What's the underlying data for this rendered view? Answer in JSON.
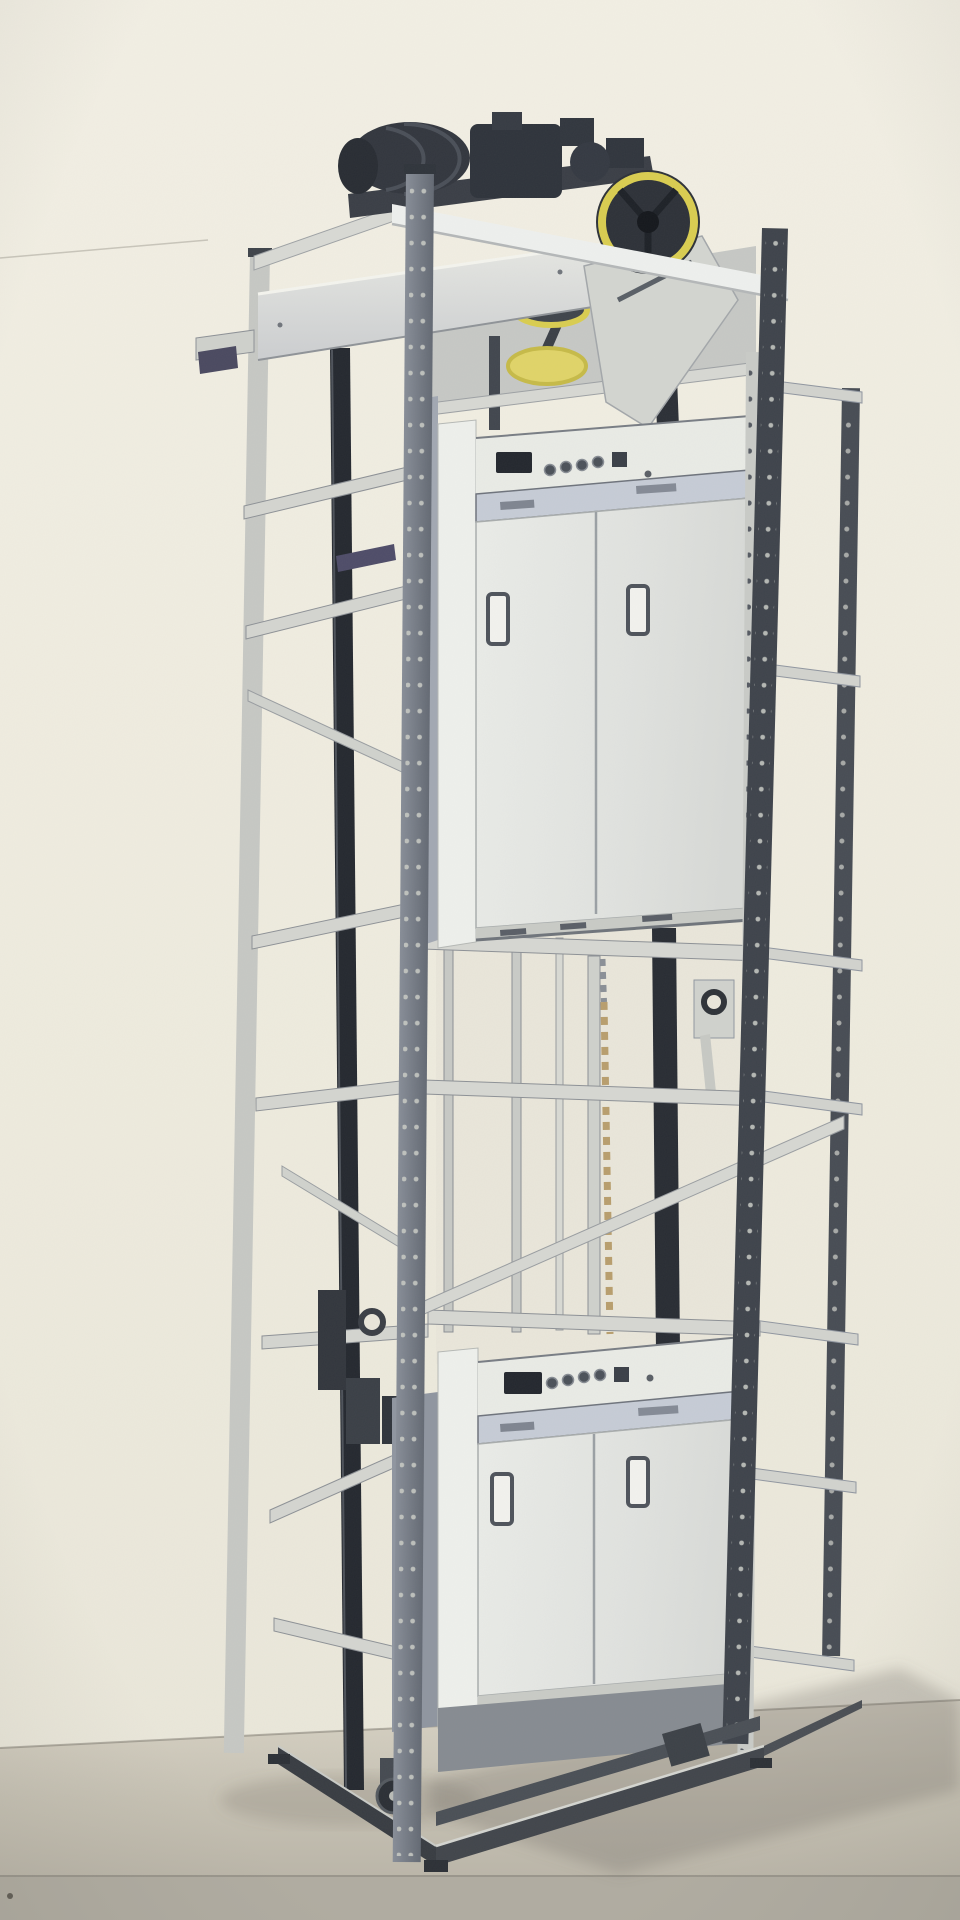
{
  "image": {
    "kind": "photograph",
    "subject": "Dumbwaiter service lift with two stacked cars on a freestanding perforated steel frame",
    "setting": "indoor showroom, beige wall, gray floor, soft shadow cast to the right",
    "visible_text": "none"
  },
  "palette": {
    "wall": "#f0ede1",
    "floor": "#c9c4b6",
    "floor_band": "#b0aca1",
    "steel_light": "#d5d6d1",
    "steel_dark": "#3e434b",
    "guide_rail": "#24282f",
    "cabin_face": "#e7e9e5",
    "cabin_band": "#c6ccd6",
    "control_display": "#23272e",
    "accent_yellow": "#d9cd50",
    "chain_tan": "#b89e6d",
    "bracket_purple": "#4e4c68"
  },
  "components": {
    "machine_unit": {
      "label": "traction machine, gearbox and motor on the top deck"
    },
    "flywheel": {
      "label": "yellow-rimmed flywheel at top right"
    },
    "drive_pulleys": {
      "label": "yellow-rimmed pulleys under the machine deck"
    },
    "top_beam": {
      "label": "white front top beam"
    },
    "frame": {
      "label": "four perforated corner posts with horizontal rails and diagonal braces"
    },
    "guide_rails": {
      "label": "dark vertical guide rails"
    },
    "upper_car": {
      "label": "upper car front with control strip and bi-parting door",
      "controls": {
        "display_window": 1,
        "round_buttons": 4,
        "square_button": 1,
        "indicator_dot": 1
      },
      "door_handles": 2
    },
    "lower_car": {
      "label": "lower car front with control strip and bi-parting door",
      "controls": {
        "display_window": 1,
        "round_buttons": 4,
        "square_button": 1,
        "indicator_dot": 1
      },
      "door_handles": 2
    },
    "chain": {
      "label": "drive chain hanging in the shaft between the cars"
    },
    "roller_guides": {
      "label": "roller guide brackets on the rails"
    },
    "base": {
      "label": "floor base frame with caster wheel and corner feet"
    }
  }
}
